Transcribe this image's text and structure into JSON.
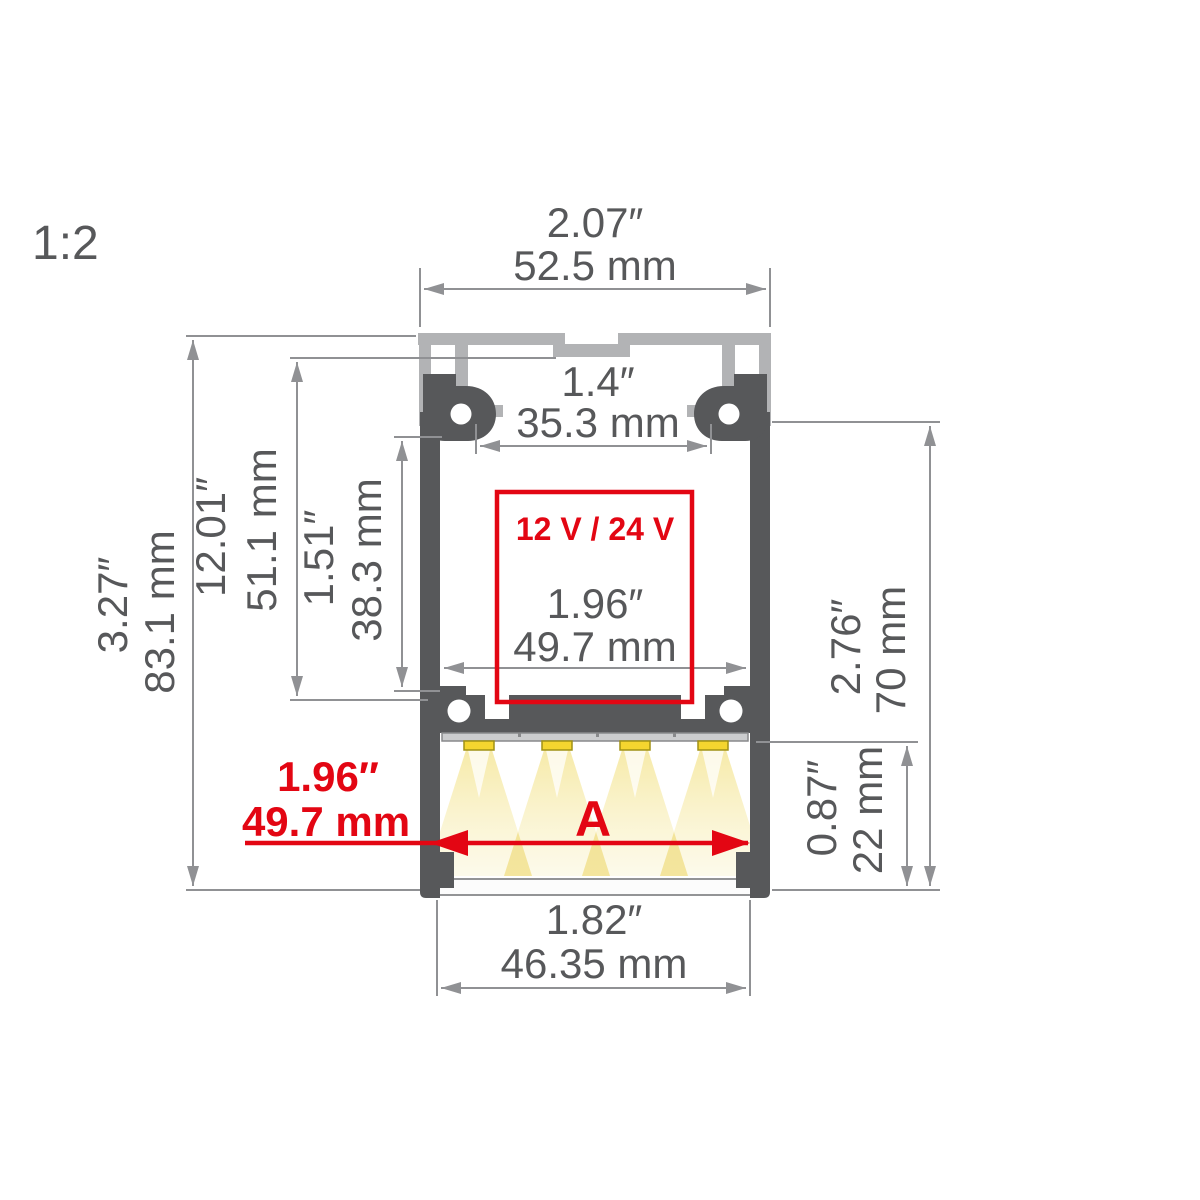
{
  "scale_label": "1:2",
  "profile": {
    "voltage_label": "12 V / 24 V",
    "arrow_label": "A"
  },
  "dims": {
    "top_width": {
      "in": "2.07″",
      "mm": "52.5 mm"
    },
    "slot_width": {
      "in": "1.4″",
      "mm": "35.3 mm"
    },
    "inner_width": {
      "in": "1.96″",
      "mm": "49.7 mm"
    },
    "total_height": {
      "in": "3.27″",
      "mm": "83.1 mm"
    },
    "upper_height": {
      "in": "12.01″",
      "mm": "51.1 mm"
    },
    "cavity_height": {
      "in": "1.51″",
      "mm": "38.3 mm"
    },
    "body_height": {
      "in": "2.76″",
      "mm": "70 mm"
    },
    "light_height": {
      "in": "0.87″",
      "mm": "22 mm"
    },
    "bottom_width": {
      "in": "1.82″",
      "mm": "46.35 mm"
    },
    "led_width": {
      "in": "1.96″",
      "mm": "49.7 mm"
    }
  },
  "colors": {
    "body_dark": "#57585a",
    "cover_light": "#b2b3b5",
    "dim_line": "#909194",
    "text_gray": "#57585a",
    "accent_red": "#e30613",
    "led_yellow": "#f4d52f",
    "beam_yellow": "#f6e9a4"
  }
}
